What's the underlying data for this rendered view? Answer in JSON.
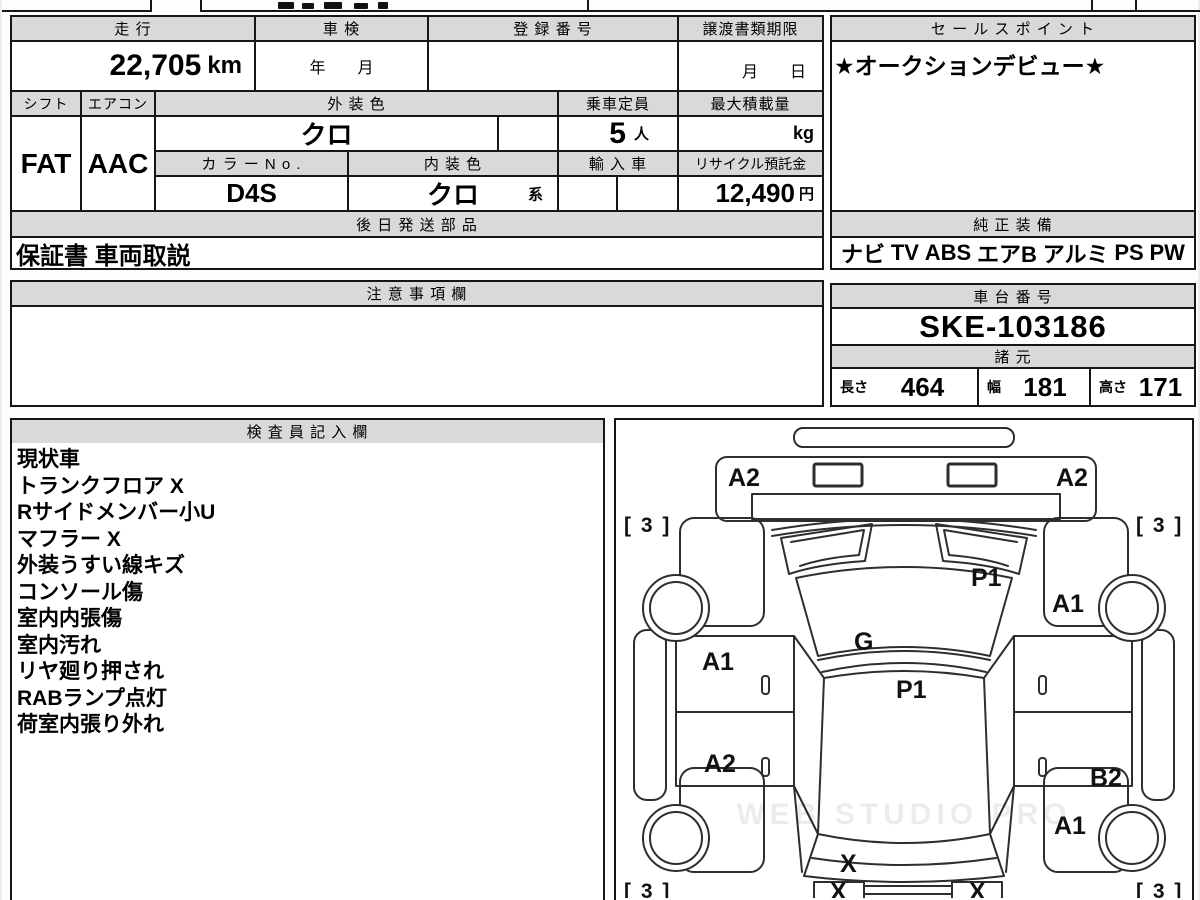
{
  "top_table": {
    "mileage": {
      "header": "走 行",
      "value": "22,705",
      "unit": "km"
    },
    "shaken": {
      "header": "車 検",
      "value": "年　　月"
    },
    "registration": {
      "header": "登 録 番 号",
      "value": ""
    },
    "transfer_docs": {
      "header": "譲渡書類期限",
      "value": "月　　日"
    },
    "shift": {
      "header": "シフト",
      "value": "FAT"
    },
    "aircon": {
      "header": "エアコン",
      "value": "AAC"
    },
    "exterior_color": {
      "header": "外 装 色",
      "value": "クロ"
    },
    "capacity": {
      "header": "乗車定員",
      "value": "5",
      "unit": "人"
    },
    "max_load": {
      "header": "最大積載量",
      "value": "",
      "unit": "kg"
    },
    "color_no": {
      "header": "カ ラ ー N o .",
      "value": "D4S"
    },
    "interior_color": {
      "header": "内 装 色",
      "value": "クロ",
      "suffix": "系"
    },
    "import_car": {
      "header": "輸 入 車",
      "value": ""
    },
    "recycle_fee": {
      "header": "リサイクル預託金",
      "value": "12,490",
      "unit": "円"
    },
    "later_parts": {
      "header": "後 日 発 送 部 品",
      "value": "保証書 車両取説"
    }
  },
  "sales_point": {
    "header": "セ ー ル ス ポ イ ン ト",
    "value": "★オークションデビュー★"
  },
  "equipment": {
    "header": "純 正 装 備",
    "items": [
      "ナビ",
      "TV",
      "ABS",
      "エアB",
      "アルミ",
      "PS",
      "PW"
    ]
  },
  "cautions": {
    "header": "注 意 事 項 欄",
    "value": ""
  },
  "chassis": {
    "header": "車 台 番 号",
    "value": "SKE-103186"
  },
  "specs": {
    "header": "諸 元",
    "dims": [
      {
        "label": "長さ",
        "value": "464"
      },
      {
        "label": "幅",
        "value": "181"
      },
      {
        "label": "高さ",
        "value": "171"
      }
    ]
  },
  "inspector": {
    "header": "検 査 員 記 入 欄",
    "notes": [
      "現状車",
      "トランクフロア X",
      "Rサイドメンバー小U",
      "マフラー X",
      "外装うすい線キズ",
      "コンソール傷",
      "室内内張傷",
      "室内汚れ",
      "リヤ廻り押され",
      "RABランプ点灯",
      "荷室内張り外れ"
    ]
  },
  "diagram": {
    "watermark": "WEB STUDIO PRO",
    "labels": [
      {
        "t": "A2",
        "x": 112,
        "y": 66
      },
      {
        "t": "A2",
        "x": 440,
        "y": 66
      },
      {
        "t": "[ 3 ]",
        "x": 8,
        "y": 112
      },
      {
        "t": "[ 3 ]",
        "x": 520,
        "y": 112
      },
      {
        "t": "P1",
        "x": 355,
        "y": 166
      },
      {
        "t": "A1",
        "x": 436,
        "y": 192
      },
      {
        "t": "G",
        "x": 238,
        "y": 230
      },
      {
        "t": "A1",
        "x": 86,
        "y": 250
      },
      {
        "t": "P1",
        "x": 280,
        "y": 278
      },
      {
        "t": "A2",
        "x": 88,
        "y": 352
      },
      {
        "t": "B2",
        "x": 474,
        "y": 366
      },
      {
        "t": "A1",
        "x": 438,
        "y": 414
      },
      {
        "t": "X",
        "x": 224,
        "y": 452
      },
      {
        "t": "[ 3 ]",
        "x": 8,
        "y": 478
      },
      {
        "t": "[ 3 ]",
        "x": 520,
        "y": 478
      },
      {
        "t": "X",
        "x": 214,
        "y": 480
      },
      {
        "t": "X",
        "x": 353,
        "y": 480
      }
    ]
  }
}
